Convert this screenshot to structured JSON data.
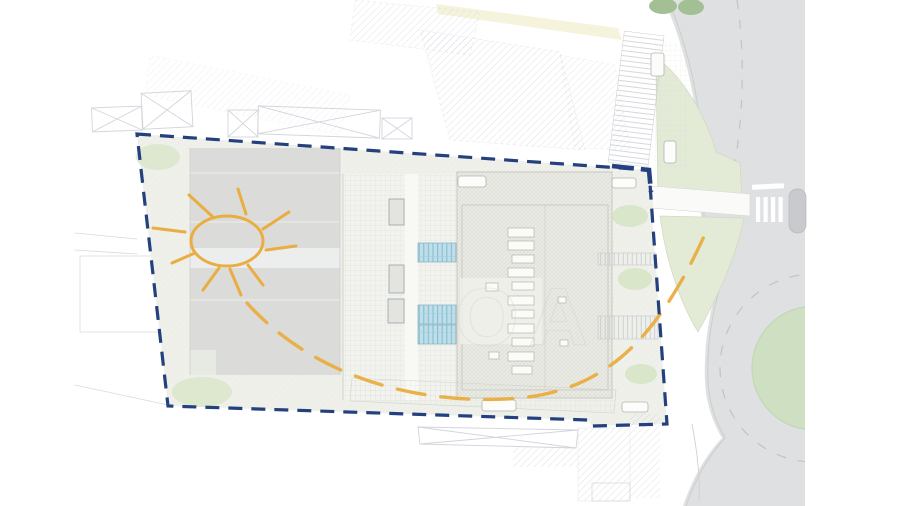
{
  "watermark": {
    "text": "OA"
  },
  "icons": {
    "sun": "sun-icon",
    "sun_path": "sun-path-arc",
    "boundary": "site-boundary-dashed"
  },
  "colors": {
    "page-bg": "#ffffff",
    "site-fill": "#eef0e9",
    "boundary": "#24407e",
    "sun": "#e9ad41",
    "building-gray": "#dbdcda",
    "building-band": "#eceded",
    "hall-fill": "#ebebe5",
    "strip-fill": "#f2f3ee",
    "road-gray": "#dfe0e2",
    "road-line": "#c2c3c7",
    "roundabout-green": "#cfdfc2",
    "landscape-green": "#e3ebd7",
    "tree-green": "#d9e6ca",
    "dark-green": "#a3c094",
    "panel-blue": "#bedfe9",
    "panel-stripe": "#86bdd1",
    "line-faint": "#c9cdd5",
    "paving-yellow": "#f5f2d8",
    "white-mark": "#ffffff"
  }
}
